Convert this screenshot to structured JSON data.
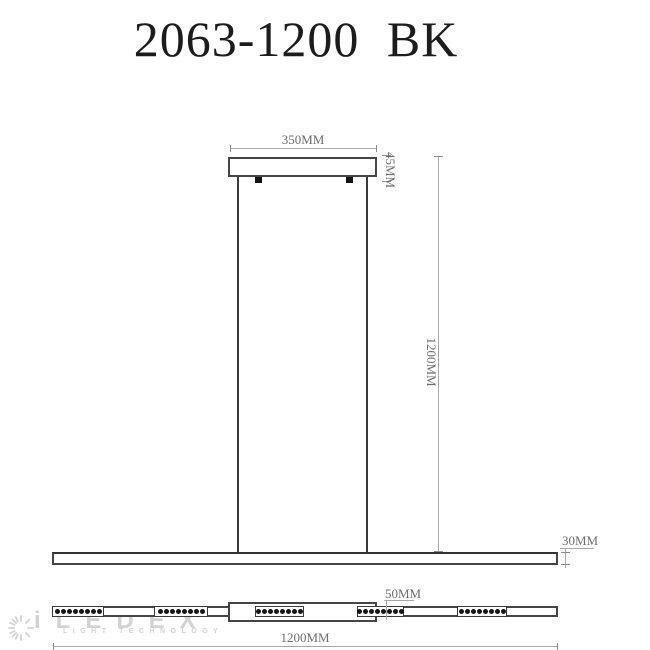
{
  "title": "2063-1200 BK",
  "dimensions": {
    "canopy_width": "350MM",
    "canopy_height": "45MM",
    "drop_height": "1200MM",
    "bar_thickness": "30MM",
    "center_offset": "50MM",
    "overall_length": "1200MM"
  },
  "bottom_view": {
    "led_groups": 5,
    "leds_per_group": 8
  },
  "watermark": {
    "brand": "iLEDEX",
    "tagline": "LIGHT TECHNOLOGY"
  },
  "colors": {
    "object_line": "#454545",
    "dimension_line": "#a8a8a8",
    "dimension_text": "#6d6d6d",
    "title_text": "#1c1c1c",
    "led_dot": "#161616",
    "watermark": "#d2d2d2",
    "background": "#ffffff"
  }
}
